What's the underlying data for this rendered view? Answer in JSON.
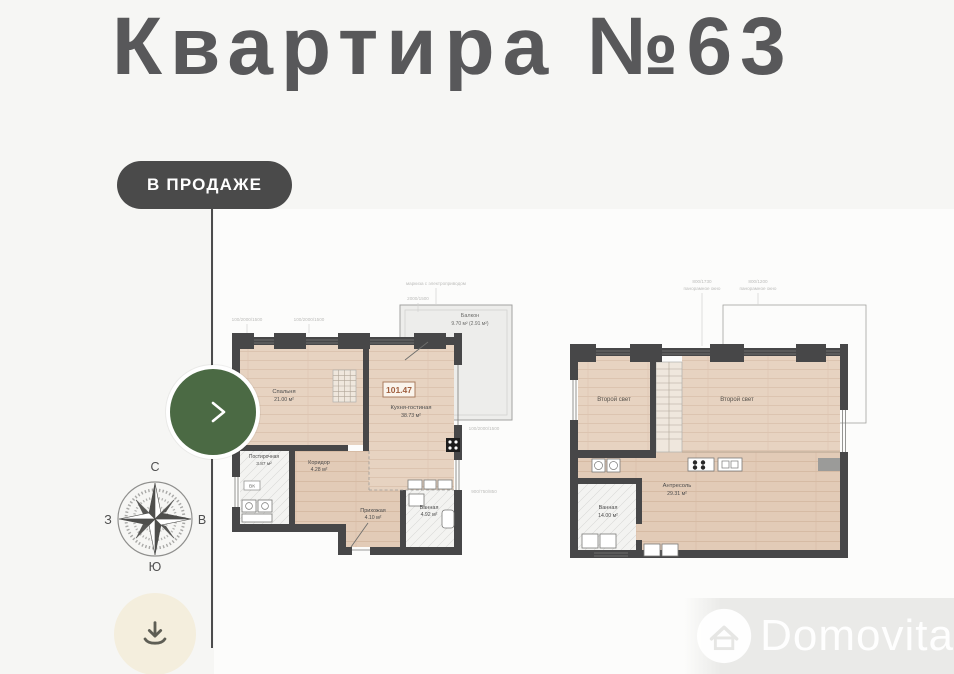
{
  "page": {
    "title": "Квартира №63",
    "badge_label": "В ПРОДАЖЕ",
    "watermark": "Domovita"
  },
  "colors": {
    "accent_green": "#4b6a44",
    "badge_bg": "#4a4a4a",
    "wall": "#474748",
    "floor_wood": "#e7d3c1",
    "total_accent": "#a05f3f",
    "download_bg": "#f4eedd"
  },
  "compass": {
    "north": "С",
    "south": "Ю",
    "west": "З",
    "east": "В"
  },
  "floor1": {
    "total_area": "101.47",
    "bedroom_name": "Спальня",
    "bedroom_area": "21.00 м²",
    "kitchen_name": "Кухня-гостиная",
    "kitchen_area": "38.73 м²",
    "laundry_name": "Постирочная",
    "laundry_area": "3.87 м²",
    "corridor_name": "Коридор",
    "corridor_area": "4.28 м²",
    "hall_name": "Прихожая",
    "hall_area": "4.10 м²",
    "bath_name": "Ванная",
    "bath_area": "4.92 м²",
    "balcony_name": "Балкон",
    "balcony_area": "9.70 м² (2.91 м²)",
    "vk_label": "ВК",
    "ann_awning": "маркиза с электроприводом",
    "ann_1": "2000/1500",
    "ann_2": "100/2000/1500",
    "ann_3": "100/2000/1500",
    "ann_4": "100/2000/1500",
    "ann_5": "900/750/850"
  },
  "floor2": {
    "void_left": "Второй свет",
    "void_right": "Второй свет",
    "mezz_name": "Антресоль",
    "mezz_area": "29.31 м²",
    "bath_name": "Ванная",
    "bath_area": "14.00 м²",
    "ann_1a": "800/1730",
    "ann_1b": "панорамное окно",
    "ann_2a": "800/1200",
    "ann_2b": "панорамное окно"
  }
}
